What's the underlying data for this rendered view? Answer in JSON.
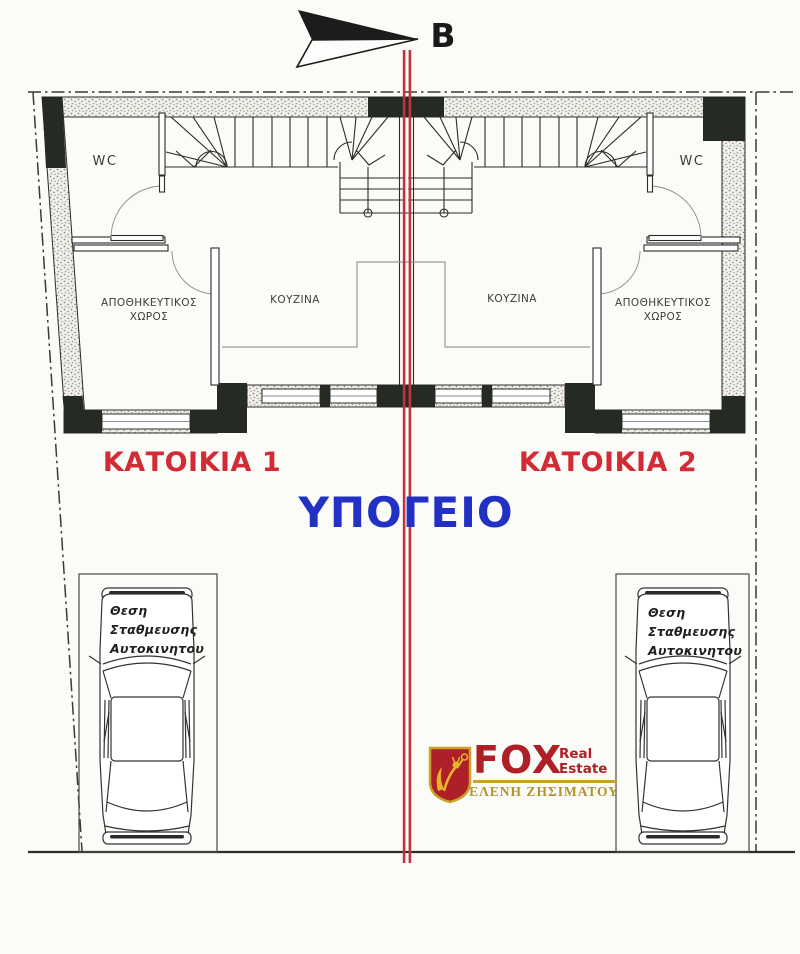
{
  "colors": {
    "unit-red": "#d22b35",
    "floor-blue": "#2231c4",
    "divider-red": "#c2333c",
    "line-dark": "#2b2b2b",
    "poche": "#252a22",
    "logo-red": "#ae1f27",
    "gold": "#c9a227",
    "gold-dark": "#b5922c",
    "label-gray": "#3d3d3d"
  },
  "north": {
    "label": "Β"
  },
  "plan": {
    "wc": "WC",
    "storage_line1": "ΑΠΟΘΗΚΕΥΤΙΚΟΣ",
    "storage_line2": "ΧΩΡΟΣ",
    "kitchen": "ΚΟΥΖΙΝΑ"
  },
  "units": {
    "unit1": "ΚΑΤΟΙΚΙΑ 1",
    "unit2": "ΚΑΤΟΙΚΙΑ 2"
  },
  "floor": {
    "label": "ΥΠΟΓΕΙΟ"
  },
  "parking": {
    "line1": "Θεση",
    "line2": "Σταθμευσης",
    "line3": "Αυτοκινητου"
  },
  "logo": {
    "brand": "FOX",
    "tag_line1": "Real",
    "tag_line2": "Estate",
    "agent": "ΕΛΕΝΗ ΖΗΣΙΜΑΤΟΥ"
  }
}
